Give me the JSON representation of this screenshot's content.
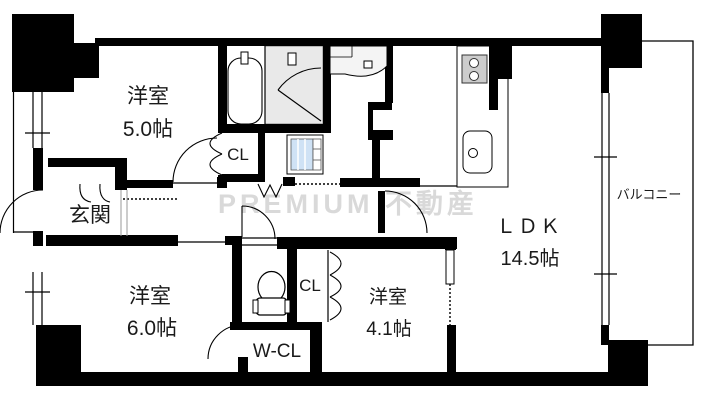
{
  "floorplan": {
    "watermark": "PREMIUM 不動産",
    "rooms": {
      "bedroom_5": {
        "name": "洋室",
        "size": "5.0帖"
      },
      "bedroom_6": {
        "name": "洋室",
        "size": "6.0帖"
      },
      "bedroom_4": {
        "name": "洋室",
        "size": "4.1帖"
      },
      "ldk": {
        "name": "ＬＤＫ",
        "size": "14.5帖"
      },
      "entrance": {
        "name": "玄関"
      },
      "closet_upper": {
        "name": "CL"
      },
      "closet_lower": {
        "name": "CL"
      },
      "walk_in_closet": {
        "name": "W-CL"
      },
      "balcony": {
        "name": "バルコニー"
      }
    },
    "colors": {
      "wall": "#000000",
      "bath_floor": "#e9e9e9",
      "stove": "#cccccc",
      "washer": "#cfe2f5",
      "watermark": "#d9d9d9"
    }
  }
}
